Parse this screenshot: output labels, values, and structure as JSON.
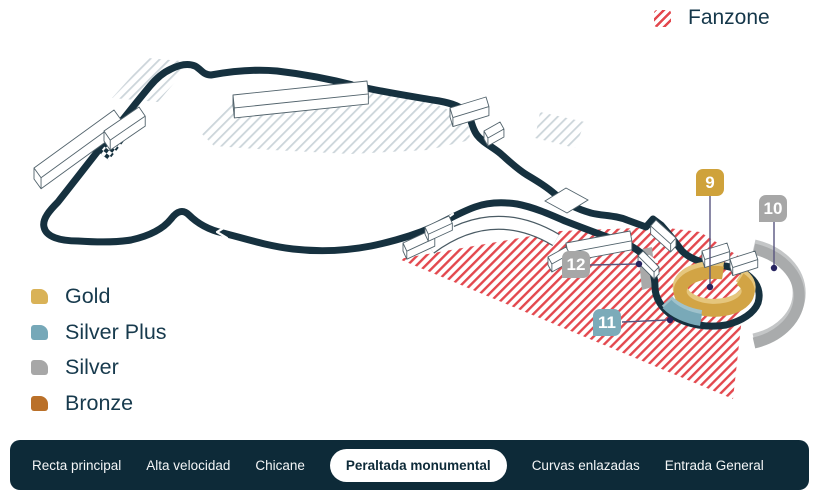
{
  "fanzone_legend": {
    "label": "Fanzone",
    "hatch_color": "#e3484e"
  },
  "ticket_legend": {
    "items": [
      {
        "label": "Gold",
        "color": "#d9b257"
      },
      {
        "label": "Silver Plus",
        "color": "#76a8b8"
      },
      {
        "label": "Silver",
        "color": "#a7a7a7"
      },
      {
        "label": "Bronze",
        "color": "#ba7029"
      }
    ]
  },
  "map": {
    "track_color": "#16313f",
    "markers": [
      {
        "number": "9",
        "color": "#cfa23b",
        "zone": "gold-grandstand"
      },
      {
        "number": "10",
        "color": "#a7a7a7",
        "zone": "outer-silver-arc"
      },
      {
        "number": "11",
        "color": "#7cabb9",
        "zone": "silver-plus-section"
      },
      {
        "number": "12",
        "color": "#a7a7a7",
        "zone": "silver-section"
      }
    ]
  },
  "nav": {
    "tabs": [
      {
        "label": "Recta principal",
        "active": false
      },
      {
        "label": "Alta velocidad",
        "active": false
      },
      {
        "label": "Chicane",
        "active": false
      },
      {
        "label": "Peraltada monumental",
        "active": true
      },
      {
        "label": "Curvas enlazadas",
        "active": false
      },
      {
        "label": "Entrada General",
        "active": false
      }
    ]
  }
}
